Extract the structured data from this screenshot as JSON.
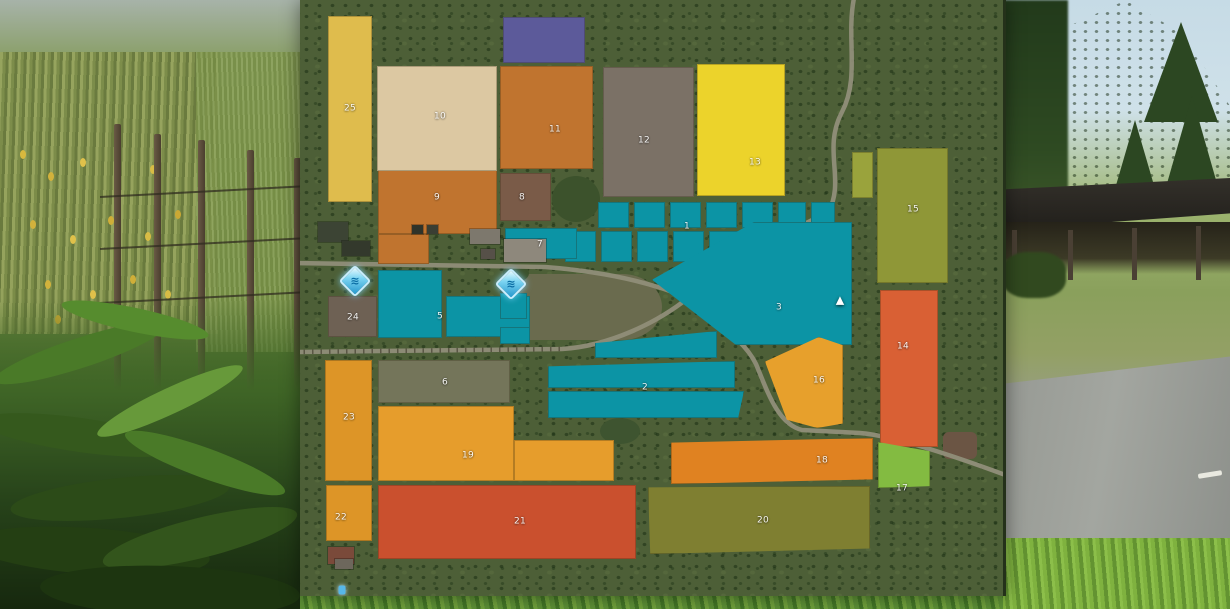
{
  "map": {
    "background_color": "#4d5f37",
    "field_number_color": "#ffffff",
    "road_color": "#908e79",
    "fields": [
      {
        "id": "1",
        "label": "1",
        "color": "#0c94a5",
        "lx": 387,
        "ly": 227,
        "parts": [
          {
            "x": 298,
            "y": 202,
            "w": 31,
            "h": 26
          },
          {
            "x": 334,
            "y": 202,
            "w": 31,
            "h": 26
          },
          {
            "x": 370,
            "y": 202,
            "w": 31,
            "h": 26
          },
          {
            "x": 406,
            "y": 202,
            "w": 31,
            "h": 26
          },
          {
            "x": 442,
            "y": 202,
            "w": 31,
            "h": 26
          },
          {
            "x": 478,
            "y": 202,
            "w": 28,
            "h": 26
          },
          {
            "x": 511,
            "y": 202,
            "w": 24,
            "h": 22
          },
          {
            "x": 265,
            "y": 231,
            "w": 31,
            "h": 31
          },
          {
            "x": 301,
            "y": 231,
            "w": 31,
            "h": 31
          },
          {
            "x": 337,
            "y": 231,
            "w": 31,
            "h": 31
          },
          {
            "x": 373,
            "y": 231,
            "w": 31,
            "h": 31
          },
          {
            "x": 409,
            "y": 231,
            "w": 31,
            "h": 31
          },
          {
            "x": 445,
            "y": 231,
            "w": 30,
            "h": 31
          },
          {
            "x": 486,
            "y": 226,
            "w": 61,
            "h": 36
          }
        ]
      },
      {
        "id": "2",
        "label": "2",
        "color": "#0c94a5",
        "lx": 345,
        "ly": 388,
        "parts": [
          {
            "x": 295,
            "y": 331,
            "w": 122,
            "h": 27,
            "clip": "polygon(0 100%,0 45%,100% 0,100% 100%)"
          },
          {
            "x": 248,
            "y": 361,
            "w": 187,
            "h": 27,
            "clip": "polygon(0 20%,100% 0,100% 100%,0 100%)"
          },
          {
            "x": 248,
            "y": 391,
            "w": 196,
            "h": 27,
            "clip": "polygon(0 0,100% 0,97% 100%,0 100%)"
          }
        ]
      },
      {
        "id": "3",
        "label": "3",
        "color": "#0c94a5",
        "lx": 479,
        "ly": 308,
        "parts": [
          {
            "x": 352,
            "y": 222,
            "w": 200,
            "h": 123,
            "clip": "polygon(0 47%,51% 0,100% 0,100% 100%,42% 100%)",
            "lines": true
          }
        ]
      },
      {
        "id": "5",
        "label": "5",
        "color": "#0c94a5",
        "lx": 140,
        "ly": 317,
        "parts": [
          {
            "x": 78,
            "y": 270,
            "w": 64,
            "h": 68
          },
          {
            "x": 146,
            "y": 296,
            "w": 84,
            "h": 41
          }
        ]
      },
      {
        "id": "6",
        "label": "6",
        "color": "#74755a",
        "lx": 145,
        "ly": 383,
        "parts": [
          {
            "x": 78,
            "y": 360,
            "w": 132,
            "h": 43
          }
        ]
      },
      {
        "id": "7",
        "label": "7",
        "color": "#0c94a5",
        "lx": 240,
        "ly": 245,
        "parts": [
          {
            "x": 205,
            "y": 228,
            "w": 72,
            "h": 31
          }
        ]
      },
      {
        "id": "8",
        "label": "8",
        "color": "#7a5b48",
        "lx": 222,
        "ly": 198,
        "parts": [
          {
            "x": 200,
            "y": 173,
            "w": 51,
            "h": 48
          }
        ]
      },
      {
        "id": "9",
        "label": "9",
        "color": "#c0742f",
        "lx": 137,
        "ly": 198,
        "parts": [
          {
            "x": 78,
            "y": 170,
            "w": 119,
            "h": 64
          },
          {
            "x": 78,
            "y": 234,
            "w": 51,
            "h": 30
          }
        ]
      },
      {
        "id": "10",
        "label": "10",
        "color": "#dcc8a2",
        "lx": 140,
        "ly": 117,
        "parts": [
          {
            "x": 77,
            "y": 66,
            "w": 120,
            "h": 105
          }
        ]
      },
      {
        "id": "11",
        "label": "11",
        "color": "#c0742f",
        "lx": 255,
        "ly": 130,
        "parts": [
          {
            "x": 200,
            "y": 66,
            "w": 93,
            "h": 103
          }
        ]
      },
      {
        "id": "12",
        "label": "12",
        "color": "#7b7166",
        "lx": 344,
        "ly": 141,
        "parts": [
          {
            "x": 303,
            "y": 67,
            "w": 91,
            "h": 130
          }
        ]
      },
      {
        "id": "13",
        "label": "13",
        "color": "#ecd32b",
        "lx": 455,
        "ly": 163,
        "parts": [
          {
            "x": 397,
            "y": 64,
            "w": 88,
            "h": 132
          }
        ]
      },
      {
        "id": "14",
        "label": "14",
        "color": "#d96034",
        "lx": 603,
        "ly": 347,
        "parts": [
          {
            "x": 580,
            "y": 290,
            "w": 58,
            "h": 157
          }
        ]
      },
      {
        "id": "15",
        "label": "15",
        "color": "#8f9737",
        "lx": 613,
        "ly": 210,
        "parts": [
          {
            "x": 577,
            "y": 148,
            "w": 71,
            "h": 135
          }
        ]
      },
      {
        "id": "16",
        "label": "16",
        "color": "#e7a02c",
        "lx": 519,
        "ly": 381,
        "parts": [
          {
            "x": 465,
            "y": 337,
            "w": 78,
            "h": 91,
            "clip": "polygon(69% 0,100% 9%,100% 95%,67% 100%,28% 91%,0 27%)"
          }
        ]
      },
      {
        "id": "17",
        "label": "17",
        "color": "#83bb41",
        "lx": 602,
        "ly": 489,
        "parts": [
          {
            "x": 578,
            "y": 442,
            "w": 52,
            "h": 46,
            "clip": "polygon(0 0,100% 20%,100% 96%,0 100%)"
          }
        ]
      },
      {
        "id": "18",
        "label": "18",
        "color": "#e08221",
        "lx": 522,
        "ly": 461,
        "parts": [
          {
            "x": 371,
            "y": 438,
            "w": 202,
            "h": 46,
            "clip": "polygon(0 10%,100% 0,100% 90%,0 100%)"
          }
        ]
      },
      {
        "id": "19",
        "label": "19",
        "color": "#e69d2c",
        "lx": 168,
        "ly": 456,
        "parts": [
          {
            "x": 78,
            "y": 406,
            "w": 136,
            "h": 75
          },
          {
            "x": 214,
            "y": 440,
            "w": 100,
            "h": 41
          }
        ]
      },
      {
        "id": "20",
        "label": "20",
        "color": "#7f7f31",
        "lx": 463,
        "ly": 521,
        "parts": [
          {
            "x": 348,
            "y": 486,
            "w": 222,
            "h": 68,
            "clip": "polygon(0 2%,100% 0,100% 92%,1% 100%)"
          }
        ]
      },
      {
        "id": "21",
        "label": "21",
        "color": "#ca502e",
        "lx": 220,
        "ly": 522,
        "parts": [
          {
            "x": 78,
            "y": 485,
            "w": 258,
            "h": 74
          }
        ]
      },
      {
        "id": "22",
        "label": "22",
        "color": "#dd9527",
        "lx": 41,
        "ly": 518,
        "parts": [
          {
            "x": 26,
            "y": 485,
            "w": 46,
            "h": 56
          }
        ]
      },
      {
        "id": "23",
        "label": "23",
        "color": "#dd9527",
        "lx": 49,
        "ly": 418,
        "parts": [
          {
            "x": 25,
            "y": 360,
            "w": 47,
            "h": 121
          }
        ]
      },
      {
        "id": "24",
        "label": "24",
        "color": "#6e6154",
        "lx": 53,
        "ly": 318,
        "parts": [
          {
            "x": 28,
            "y": 296,
            "w": 49,
            "h": 41
          }
        ]
      },
      {
        "id": "25",
        "label": "25",
        "color": "#dfbc4d",
        "lx": 50,
        "ly": 109,
        "parts": [
          {
            "x": 28,
            "y": 16,
            "w": 44,
            "h": 186
          }
        ]
      },
      {
        "id": "",
        "label": "",
        "color": "#5c5a9a",
        "parts": [
          {
            "x": 203,
            "y": 17,
            "w": 82,
            "h": 46
          }
        ]
      },
      {
        "id": "",
        "label": "",
        "color": "#9aa33c",
        "parts": [
          {
            "x": 552,
            "y": 152,
            "w": 21,
            "h": 46
          }
        ]
      },
      {
        "id": "",
        "label": "",
        "color": "#0c94a5",
        "parts": [
          {
            "x": 200,
            "y": 293,
            "w": 27,
            "h": 26
          },
          {
            "x": 200,
            "y": 327,
            "w": 30,
            "h": 17
          }
        ]
      }
    ],
    "terrain": [
      {
        "name": "pond-meadow",
        "x": 210,
        "y": 274,
        "w": 152,
        "h": 66,
        "color": "#6a6b4e",
        "radius": "0 40px 40px 0 / 0 33px 33px 0"
      },
      {
        "name": "dirt-patch",
        "x": 643,
        "y": 432,
        "w": 34,
        "h": 27,
        "color": "#6b5544",
        "radius": "6px"
      },
      {
        "name": "tree-cluster",
        "x": 252,
        "y": 176,
        "w": 48,
        "h": 46,
        "color": "#3c522c",
        "radius": "50%"
      },
      {
        "name": "tree-cluster",
        "x": 160,
        "y": 176,
        "w": 30,
        "h": 22,
        "color": "#465934",
        "radius": "50%"
      },
      {
        "name": "tree-cluster",
        "x": 203,
        "y": 264,
        "w": 26,
        "h": 18,
        "color": "#3c522c",
        "radius": "50%"
      },
      {
        "name": "tree-cluster",
        "x": 300,
        "y": 418,
        "w": 40,
        "h": 26,
        "color": "#3e5430",
        "radius": "50%"
      },
      {
        "name": "tree-cluster",
        "x": 112,
        "y": 420,
        "w": 34,
        "h": 22,
        "color": "#3e5430",
        "radius": "50%"
      }
    ],
    "buildings": [
      {
        "x": 18,
        "y": 222,
        "w": 30,
        "h": 20,
        "color": "#3c4434"
      },
      {
        "x": 42,
        "y": 241,
        "w": 28,
        "h": 15,
        "color": "#33392c"
      },
      {
        "x": 112,
        "y": 225,
        "w": 11,
        "h": 9,
        "color": "#2f332a"
      },
      {
        "x": 127,
        "y": 225,
        "w": 11,
        "h": 9,
        "color": "#3a3e33"
      },
      {
        "x": 170,
        "y": 229,
        "w": 30,
        "h": 15,
        "color": "#7d786d"
      },
      {
        "x": 204,
        "y": 239,
        "w": 42,
        "h": 23,
        "color": "#8e887c"
      },
      {
        "x": 181,
        "y": 249,
        "w": 14,
        "h": 10,
        "color": "#565048"
      },
      {
        "x": 28,
        "y": 547,
        "w": 26,
        "h": 17,
        "color": "#7a4a3a"
      },
      {
        "x": 35,
        "y": 559,
        "w": 18,
        "h": 10,
        "color": "#6d675c"
      }
    ],
    "icons": [
      {
        "kind": "water",
        "name": "water-station-icon",
        "glyph": "≋",
        "x": 55,
        "y": 281
      },
      {
        "kind": "water",
        "name": "water-station-icon",
        "glyph": "≋",
        "x": 211,
        "y": 284
      },
      {
        "kind": "marker",
        "name": "waypoint-marker-icon",
        "glyph": "▲",
        "x": 540,
        "y": 300
      },
      {
        "kind": "player",
        "name": "player-marker-icon",
        "glyph": "",
        "x": 42,
        "y": 590
      }
    ]
  }
}
